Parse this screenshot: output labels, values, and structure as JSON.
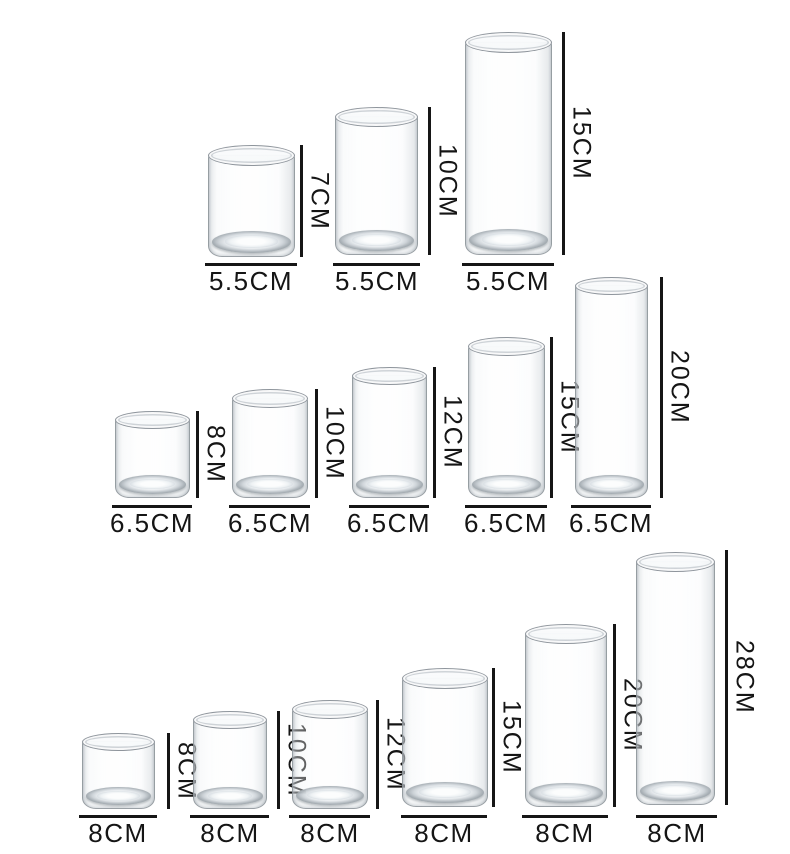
{
  "colors": {
    "background": "#ffffff",
    "dimension_line": "#161616",
    "label_text": "#151515",
    "glass_outline": "#8a9197"
  },
  "rows": [
    {
      "diameter_label": "5.5CM",
      "vases": [
        {
          "height": "7CM",
          "diameter": "5.5CM",
          "height_cm": 7,
          "diameter_cm": 5.5
        },
        {
          "height": "10CM",
          "diameter": "5.5CM",
          "height_cm": 10,
          "diameter_cm": 5.5
        },
        {
          "height": "15CM",
          "diameter": "5.5CM",
          "height_cm": 15,
          "diameter_cm": 5.5
        }
      ]
    },
    {
      "diameter_label": "6.5CM",
      "vases": [
        {
          "height": "8CM",
          "diameter": "6.5CM",
          "height_cm": 8,
          "diameter_cm": 6.5
        },
        {
          "height": "10CM",
          "diameter": "6.5CM",
          "height_cm": 10,
          "diameter_cm": 6.5
        },
        {
          "height": "12CM",
          "diameter": "6.5CM",
          "height_cm": 12,
          "diameter_cm": 6.5
        },
        {
          "height": "15CM",
          "diameter": "6.5CM",
          "height_cm": 15,
          "diameter_cm": 6.5
        },
        {
          "height": "20CM",
          "diameter": "6.5CM",
          "height_cm": 20,
          "diameter_cm": 6.5
        }
      ]
    },
    {
      "diameter_label": "8CM",
      "vases": [
        {
          "height": "8CM",
          "diameter": "8CM",
          "height_cm": 8,
          "diameter_cm": 8
        },
        {
          "height": "10CM",
          "diameter": "8CM",
          "height_cm": 10,
          "diameter_cm": 8
        },
        {
          "height": "12CM",
          "diameter": "8CM",
          "height_cm": 12,
          "diameter_cm": 8
        },
        {
          "height": "15CM",
          "diameter": "8CM",
          "height_cm": 15,
          "diameter_cm": 8
        },
        {
          "height": "20CM",
          "diameter": "8CM",
          "height_cm": 20,
          "diameter_cm": 8
        },
        {
          "height": "28CM",
          "diameter": "8CM",
          "height_cm": 28,
          "diameter_cm": 8
        }
      ]
    }
  ]
}
